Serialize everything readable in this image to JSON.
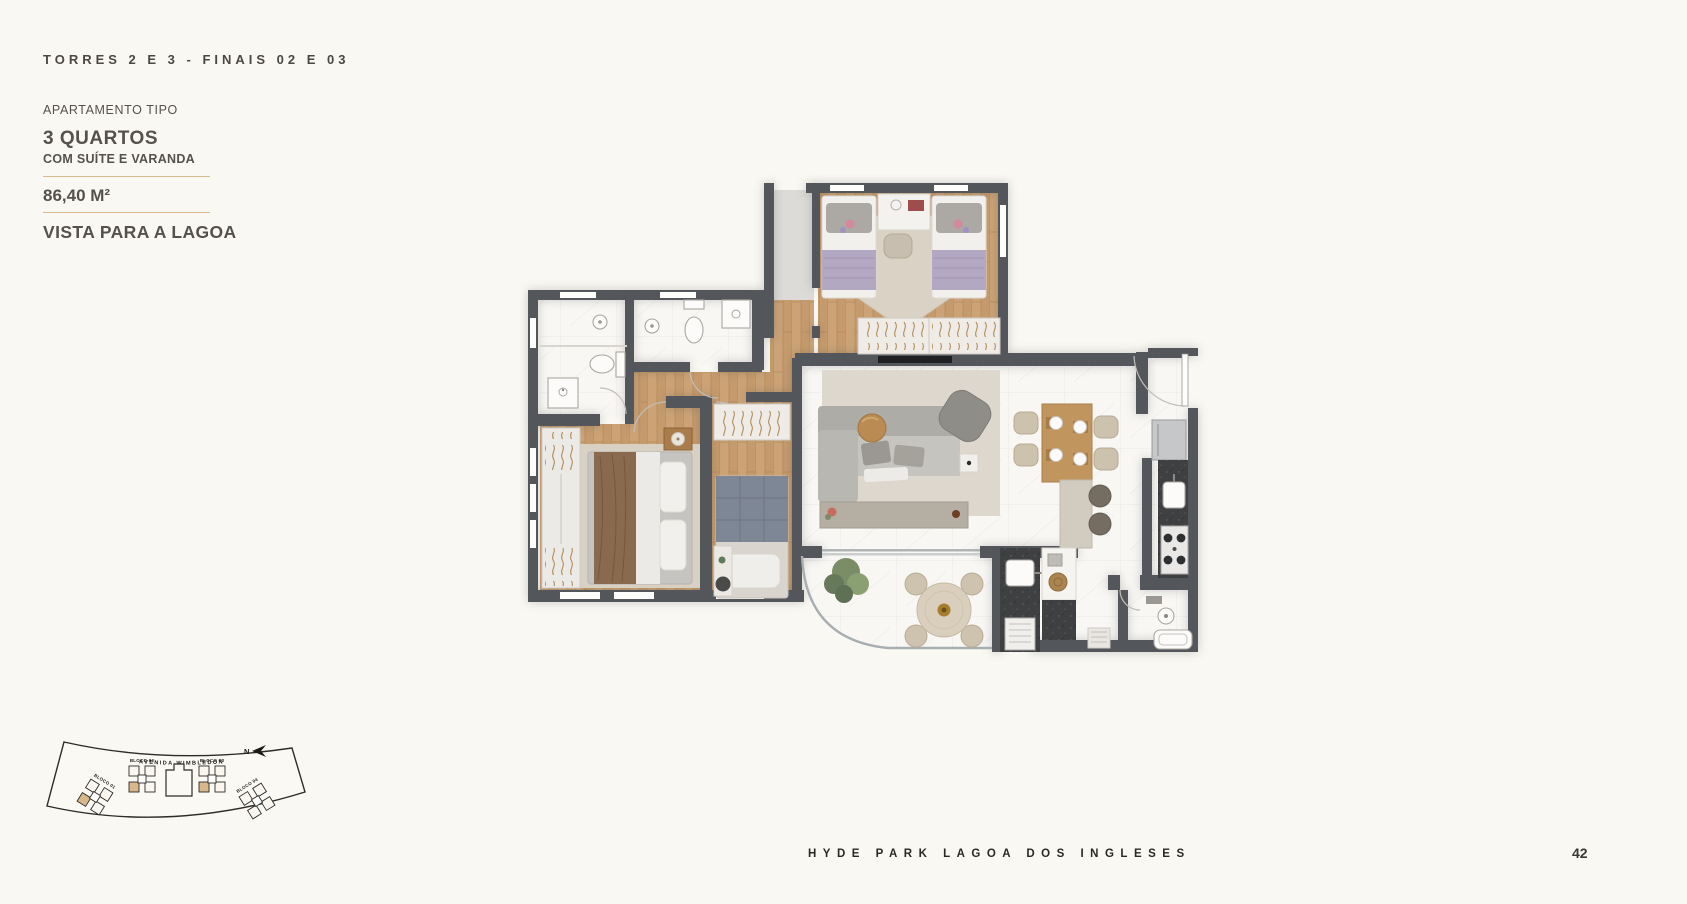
{
  "header": {
    "kicker": "TORRES 2 E 3 - FINAIS 02 E 03",
    "apartment_type_label": "APARTAMENTO TIPO",
    "title": "3 QUARTOS",
    "subtitle": "COM SUÍTE E VARANDA",
    "area": "86,40 M²",
    "view": "VISTA PARA A LAGOA"
  },
  "colors": {
    "background": "#FAF8F2",
    "text": "#55514B",
    "gold_rule": "#D9BA8E",
    "wall": "#53565A",
    "wood_floor": "#C59B6D",
    "marble_floor": "#F8F7F4",
    "granite_counter": "#3E4042",
    "highlight_unit": "#D8B78A"
  },
  "floorplan": {
    "rooms": [
      "entry-hall",
      "twin-bedroom",
      "suite-bathroom",
      "social-bathroom",
      "master-suite",
      "third-bedroom",
      "corridor",
      "living-room",
      "dining-area",
      "kitchen",
      "gourmet-counter",
      "balcony-varanda",
      "service-bathroom"
    ]
  },
  "sitemap": {
    "street": "AVENIDA WIMBLEDON",
    "north": "N",
    "blocks": [
      "BLOCO 01",
      "BLOCO 02",
      "BLOCO 03",
      "BLOCO 04"
    ]
  },
  "footer": {
    "brand": "HYDE PARK LAGOA DOS INGLESES",
    "page_number": "42"
  }
}
